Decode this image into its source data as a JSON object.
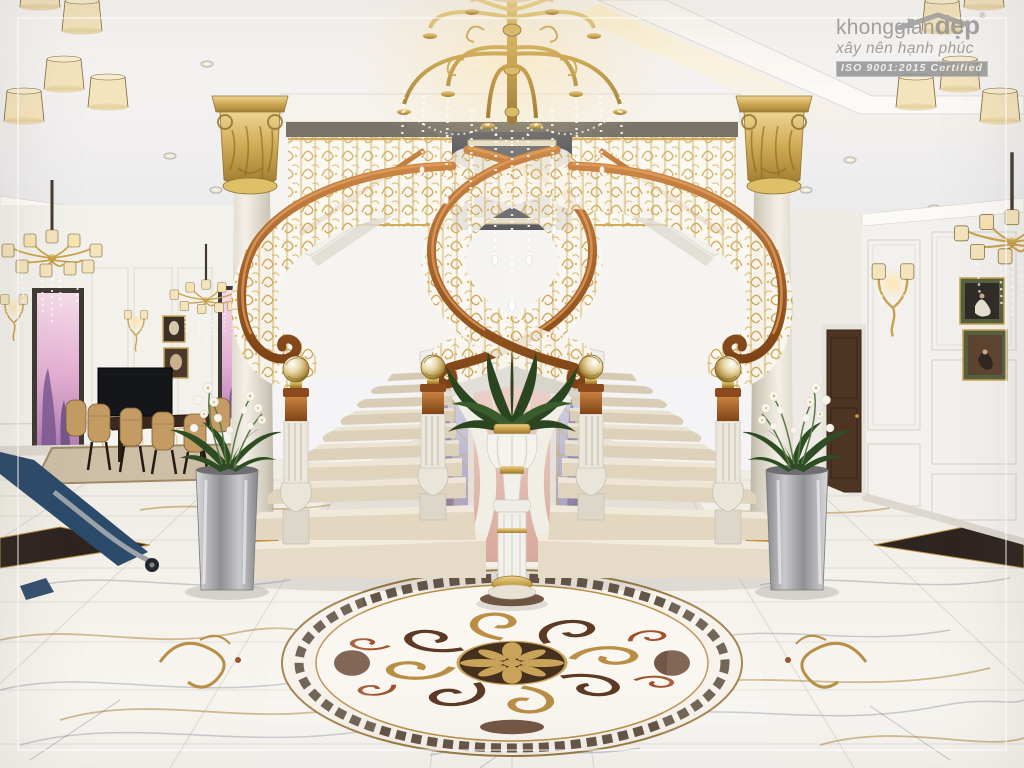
{
  "watermark": {
    "brand_prefix": "khonggian",
    "brand_suffix": "đẹp",
    "registered_mark": "®",
    "tagline": "xây nên hạnh phúc",
    "certification": "ISO 9001:2015 Certified"
  },
  "palette": {
    "gold": "#c9a24a",
    "goldDeep": "#8a6a28",
    "wood": "#a85a22",
    "woodHi": "#d0873f",
    "marble": "#f3f0e9",
    "stepCream": "#e6dcc8",
    "wall": "#f3f1ec",
    "ceiling": "#f4f3f5",
    "sunset": "#e3aed2",
    "plantGreen": "#2f4d24",
    "silver": "#b9b9bd",
    "medallionBrown": "#45301f",
    "medallionMaroon": "#a0522d"
  },
  "scene": {
    "description": "Double curved marble staircase with ornate gold balustrades and wooden handrails, flanked by gold Corinthian columns, crystal chandelier above, palm urn on pedestal at center, white marble floor with inlaid medallion; dining room at left, paneled wall with paintings at right.",
    "objects": [
      "crystal-chandelier",
      "double-curved-staircase",
      "corinthian-columns",
      "palm-urn-pedestal",
      "floor-medallion",
      "orchid-planters",
      "dining-set",
      "wall-sconces",
      "classical-paintings",
      "sunset-windows",
      "wood-door",
      "tv-sideboard"
    ]
  }
}
